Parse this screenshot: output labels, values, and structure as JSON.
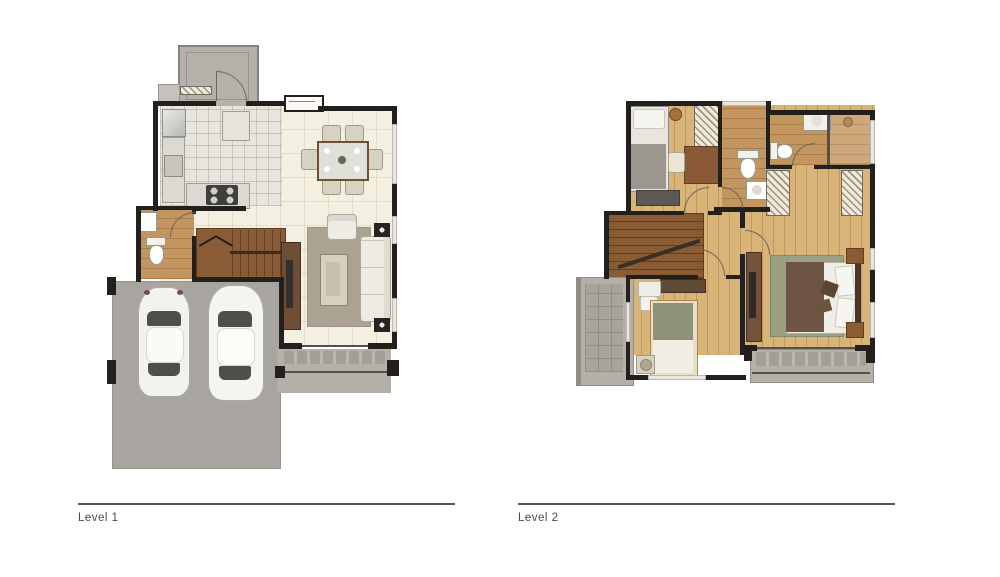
{
  "captions": {
    "level1": "Level 1",
    "level2": "Level 2"
  },
  "colors": {
    "wall": "#23201b",
    "tile-cream": "#f4f0e1",
    "tile-kitchen": "#e7e5de",
    "wood-light": "#d9b478",
    "wood-medium": "#c3955f",
    "stair-brown": "#8a5c36",
    "driveway": "#a8a5a0",
    "porch": "#b4b1ab",
    "balcony": "#b3b0aa",
    "rug-taupe": "#aca395",
    "rug-green": "#9aa183",
    "furniture-light": "#edebe4",
    "wood-dark": "#6e4f33",
    "caption-text": "#4c4a46"
  }
}
